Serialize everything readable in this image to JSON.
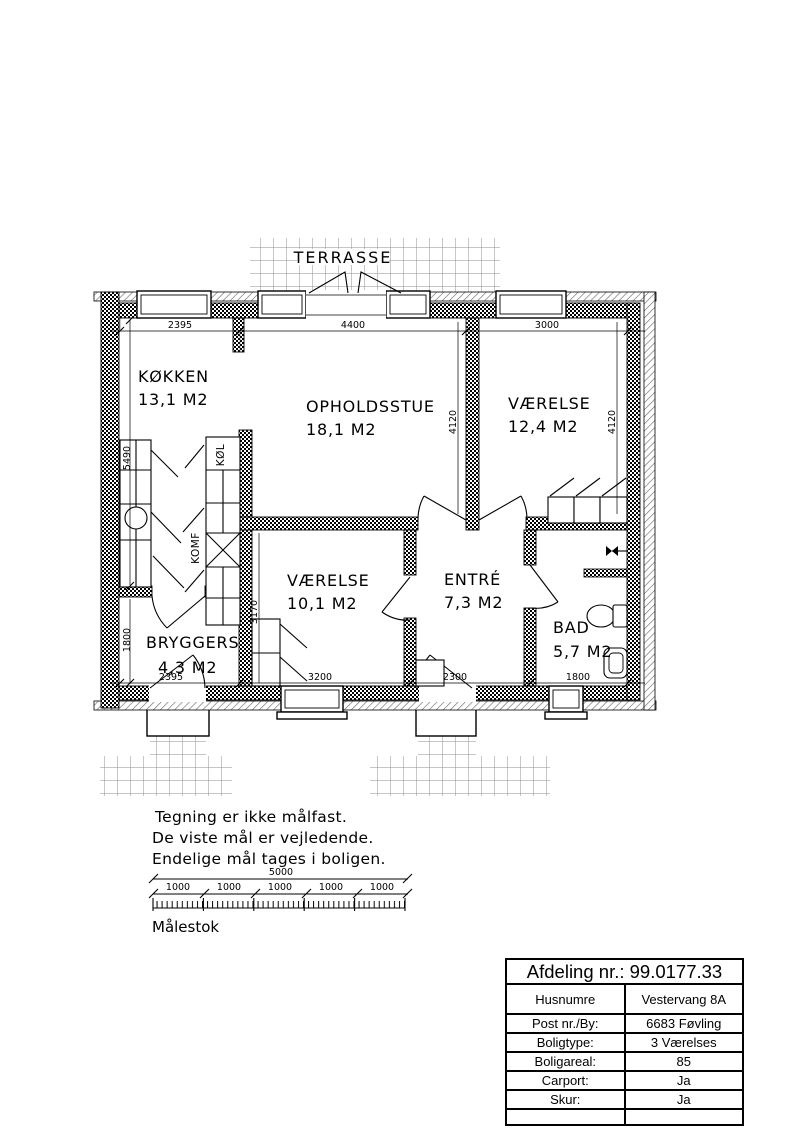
{
  "colors": {
    "ink": "#000000",
    "hatch_gray": "#6f6f6f",
    "tile_gray": "#8f8f8f"
  },
  "plan": {
    "terrace_label": "TERRASSE",
    "rooms": {
      "kitchen": {
        "name": "KØKKEN",
        "area": "13,1 M2"
      },
      "living": {
        "name": "OPHOLDSSTUE",
        "area": "18,1 M2"
      },
      "bedroom1": {
        "name": "VÆRELSE",
        "area": "12,4 M2"
      },
      "bedroom2": {
        "name": "VÆRELSE",
        "area": "10,1 M2"
      },
      "entry": {
        "name": "ENTRÉ",
        "area": "7,3 M2"
      },
      "bath": {
        "name": "BAD",
        "area": "5,7 M2"
      },
      "utility": {
        "name": "BRYGGERS",
        "area": "4,3 M2"
      }
    },
    "appliances": {
      "fridge": "KØL",
      "stove": "KOMF"
    },
    "dims": {
      "top_kitchen": "2395",
      "top_living": "4400",
      "top_bedroom1": "3000",
      "living_height": "4120",
      "bedroom1_height": "4120",
      "left_kitchen": "5490",
      "left_utility": "1800",
      "bedroom2_height": "3170",
      "bottom_utility": "2395",
      "bottom_bedroom2": "3200",
      "bottom_entry": "2300",
      "bottom_bath": "1800"
    }
  },
  "notes": {
    "line1": "Tegning er ikke målfast.",
    "line2": "De viste mål er vejledende.",
    "line3": "Endelige mål tages i boligen."
  },
  "scalebar": {
    "total": "5000",
    "segments": [
      "1000",
      "1000",
      "1000",
      "1000",
      "1000"
    ],
    "label": "Målestok"
  },
  "info_table": {
    "header": "Afdeling nr.: 99.0177.33",
    "rows": [
      {
        "label": "Husnumre",
        "value": "Vestervang 8A"
      },
      {
        "label": "Post nr./By:",
        "value": "6683 Føvling"
      },
      {
        "label": "Boligtype:",
        "value": "3 Værelses"
      },
      {
        "label": "Boligareal:",
        "value": "85"
      },
      {
        "label": "Carport:",
        "value": "Ja"
      },
      {
        "label": "Skur:",
        "value": "Ja"
      }
    ]
  }
}
